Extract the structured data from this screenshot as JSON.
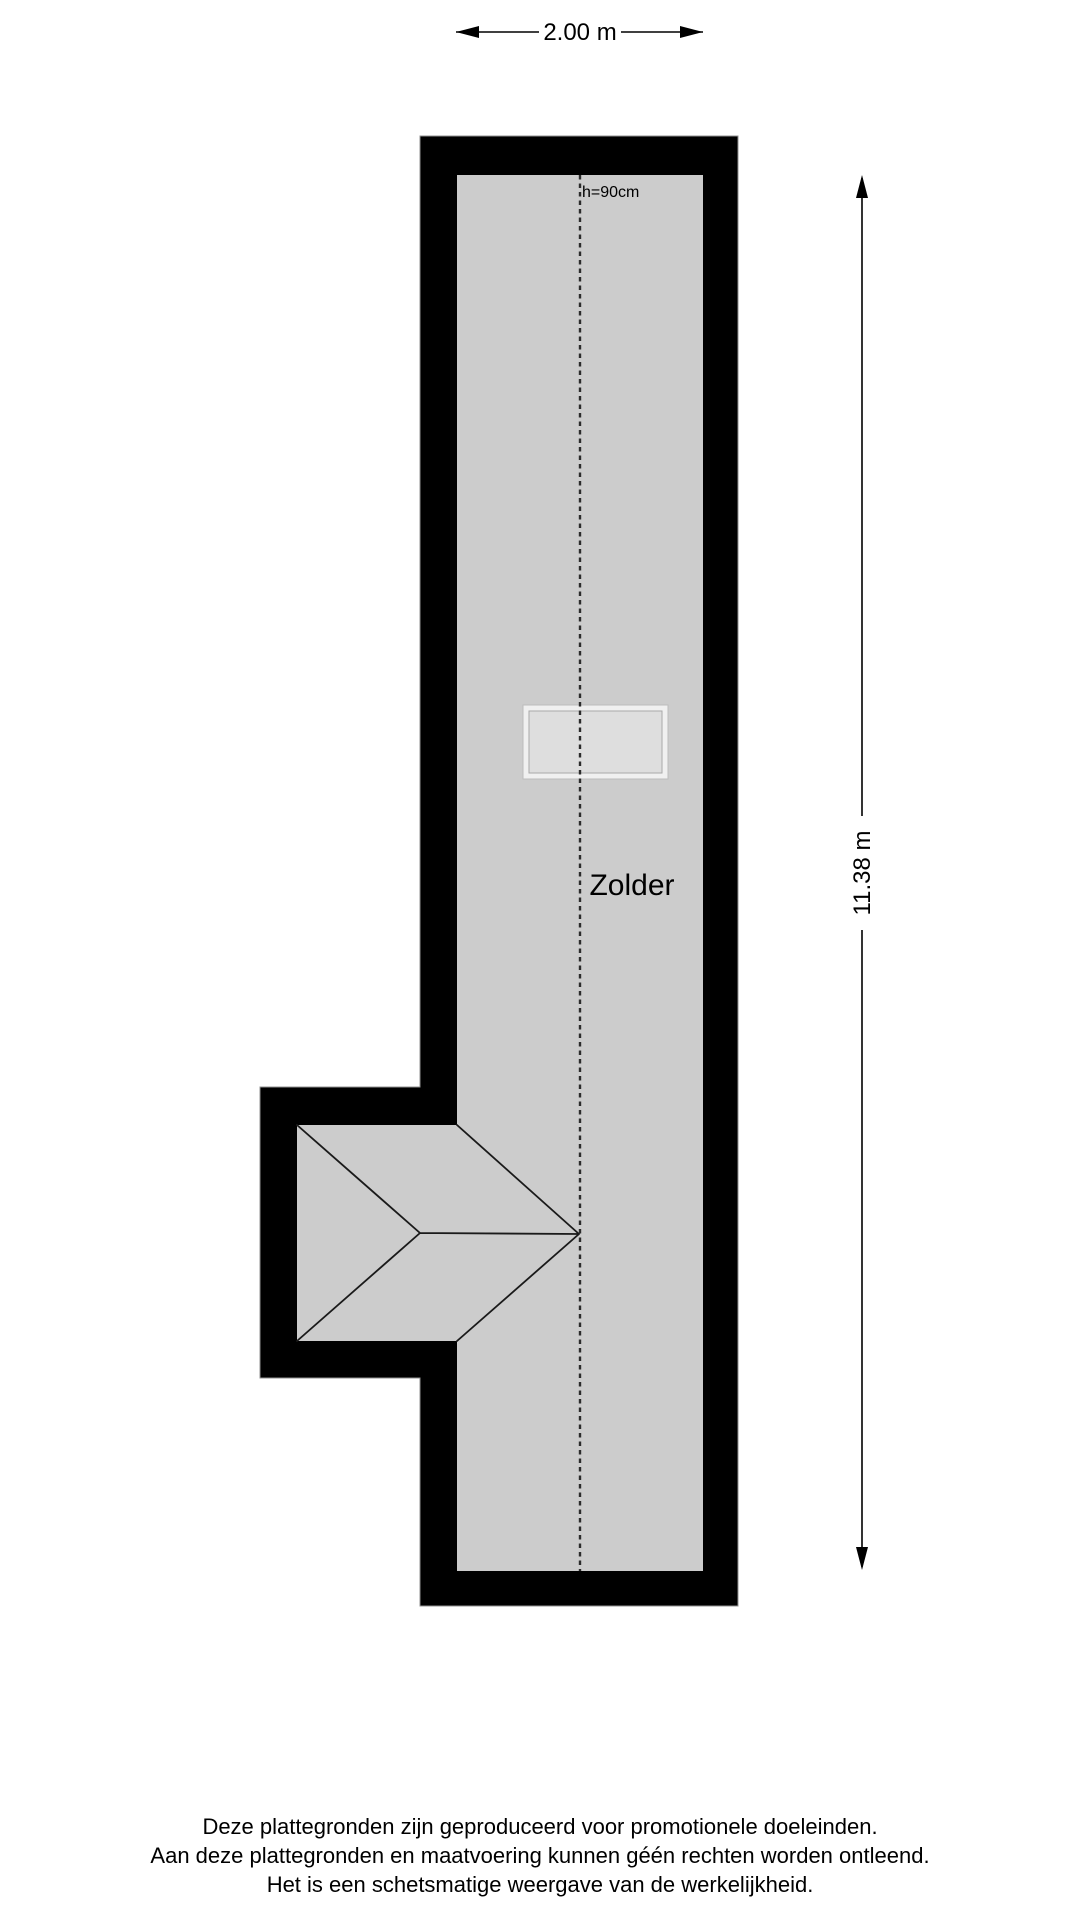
{
  "colors": {
    "background": "#ffffff",
    "wall": "#000000",
    "floor": "#cccccc",
    "roof-line": "#1a1a1a",
    "centerline": "#2b2b2b",
    "dimension": "#000000",
    "skylight-frame": "#f0f0f0",
    "skylight-glass": "#dedede",
    "skylight-edge": "#a9a9a9",
    "text": "#000000"
  },
  "floorplan": {
    "room_label": "Zolder",
    "height_note": "h=90cm",
    "width_dimension_label": "2.00 m",
    "height_dimension_label": "11.38 m"
  },
  "footer": {
    "line1": "Deze plattegronden zijn geproduceerd voor promotionele doeleinden.",
    "line2": "Aan deze plattegronden en maatvoering kunnen géén rechten worden ontleend.",
    "line3": "Het is een schetsmatige weergave van de werkelijkheid."
  }
}
